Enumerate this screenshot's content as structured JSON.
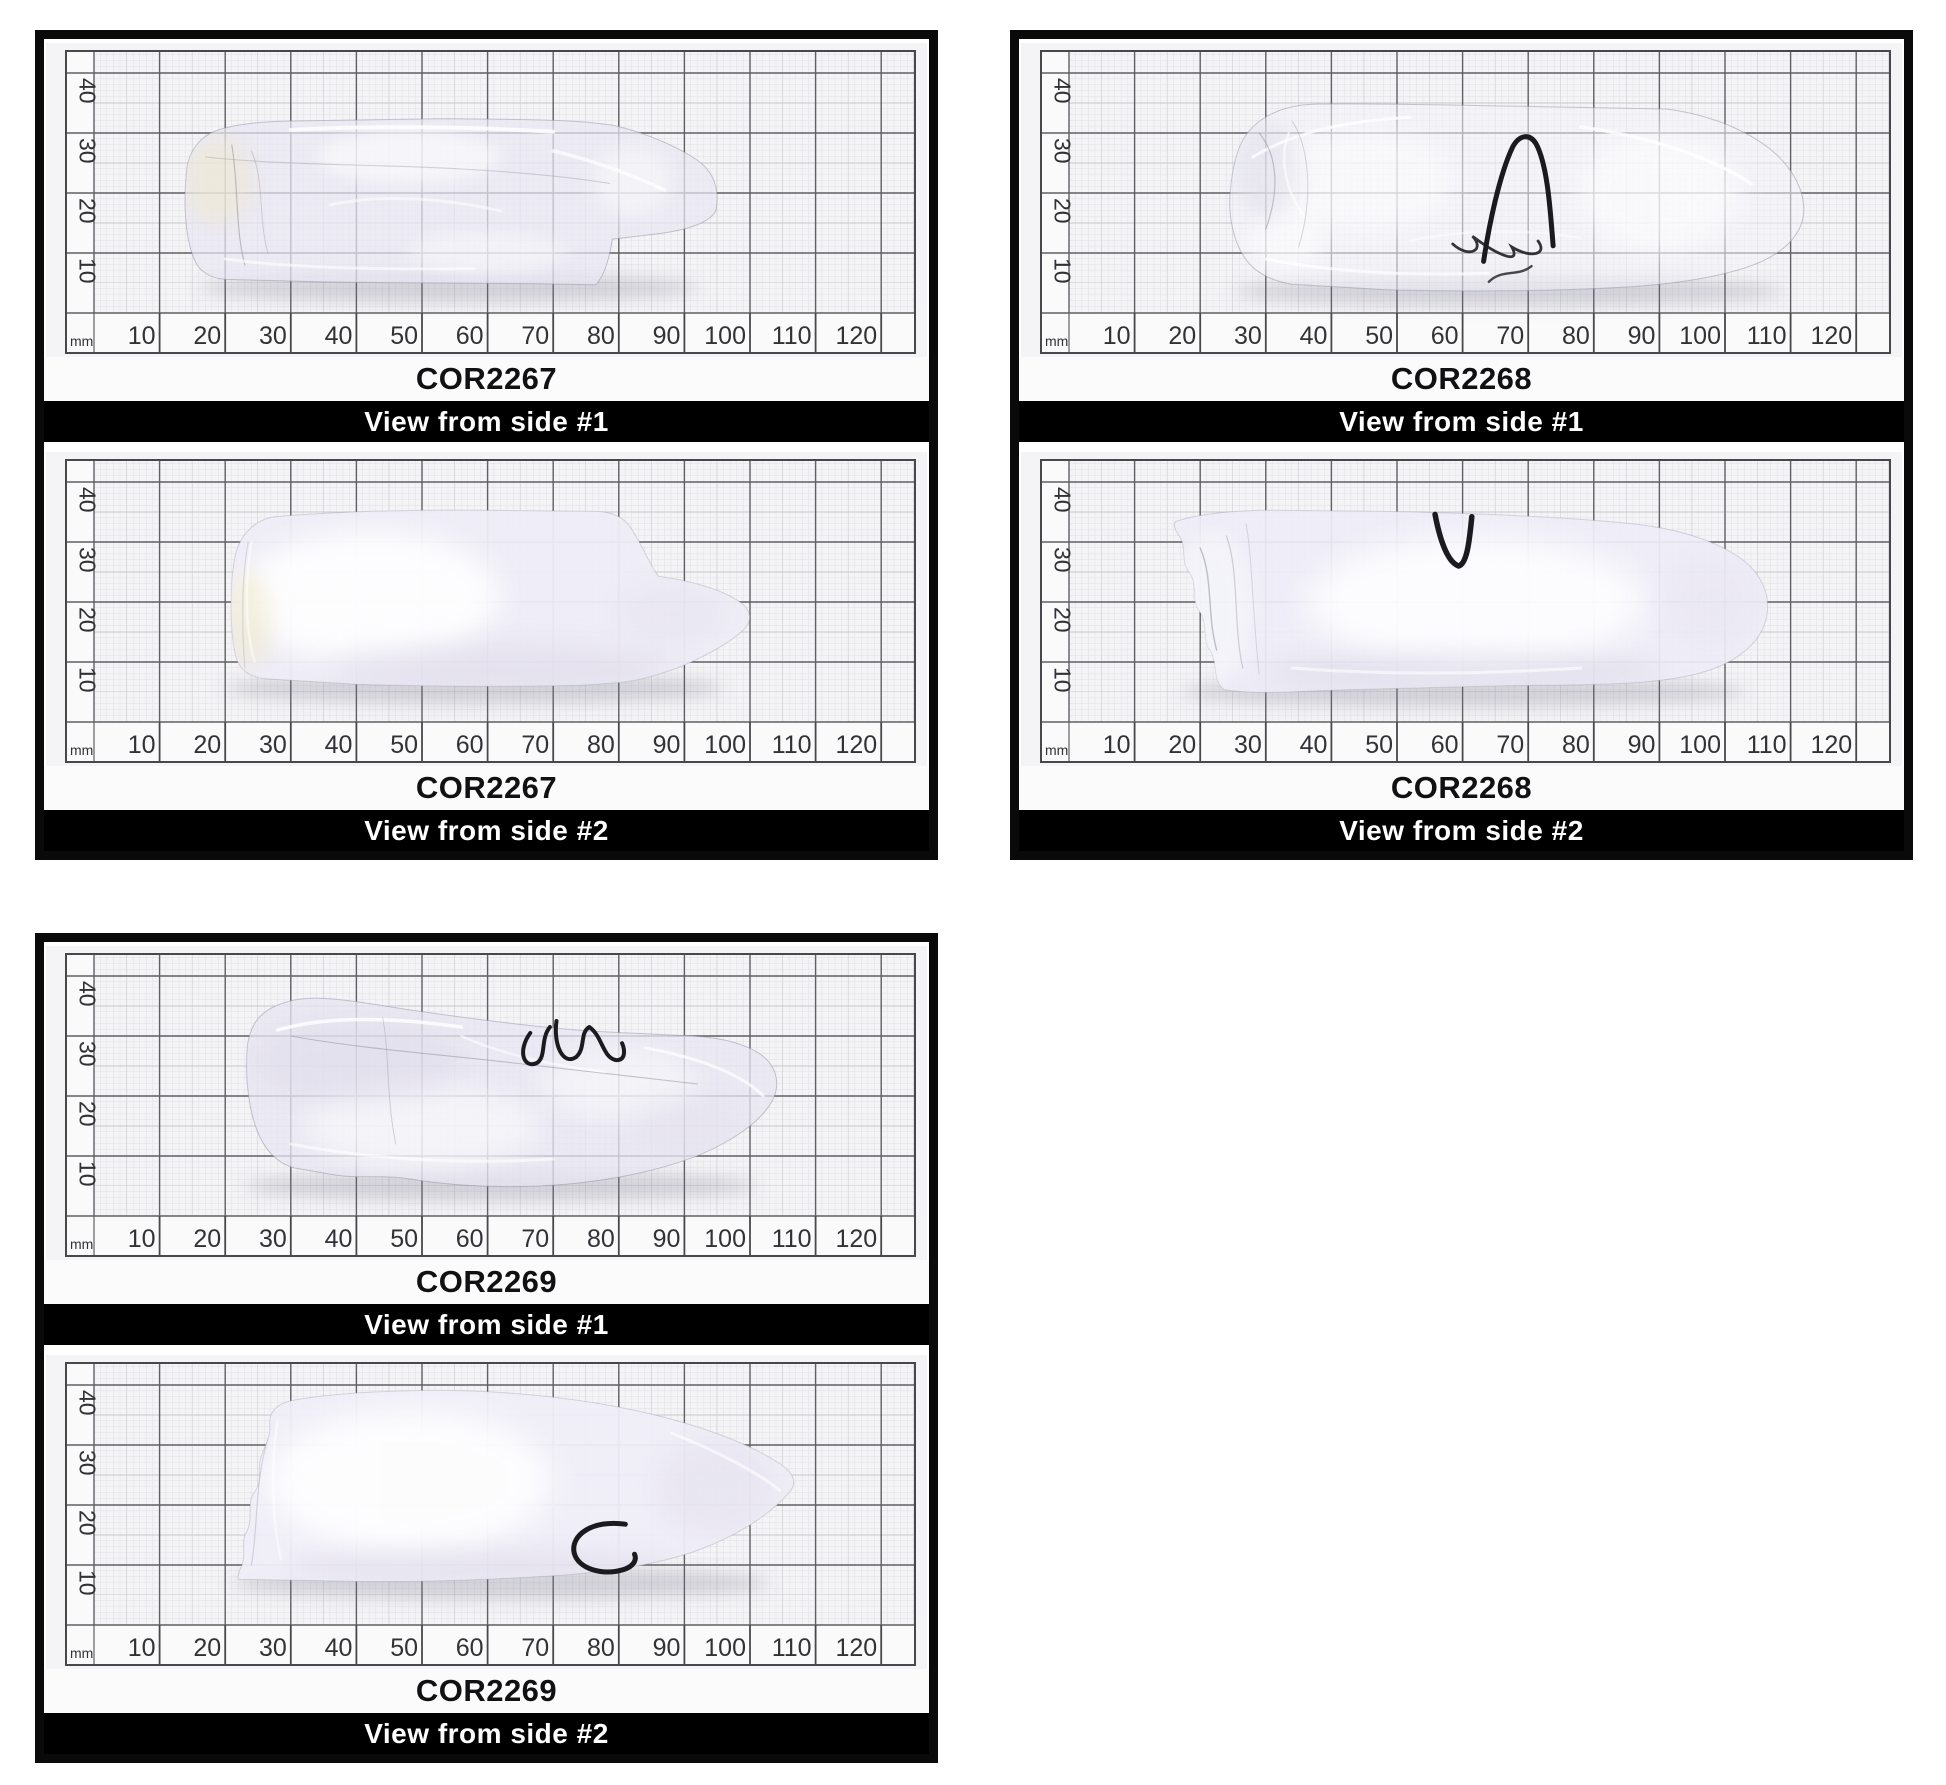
{
  "ruler": {
    "unit_label": "mm",
    "x_ticks": [
      10,
      20,
      30,
      40,
      50,
      60,
      70,
      80,
      90,
      100,
      110,
      120
    ],
    "y_ticks": [
      10,
      20,
      30,
      40
    ]
  },
  "colors": {
    "paper": "#f4f3f5",
    "ruler_strip": "#fafafb",
    "grid_fine": "#dcdde0",
    "grid_mid": "#c6c8cc",
    "grid_major": "#5f6064",
    "frame": "#47484c",
    "tick_text": "#323236",
    "shadow": "rgba(110,110,132,0.25)",
    "marker": "#1b1b1f",
    "border": "#0a0a0a",
    "caption_bg": "#000000",
    "caption_text": "#ffffff"
  },
  "panels": [
    {
      "views": [
        {
          "label": "COR2267",
          "caption": "View from side #1",
          "crystal": {
            "style": "clear",
            "fill": "rgba(233,230,243,0.72)",
            "outline": "rgba(145,145,165,0.5)",
            "path": "M14.2 24.5 C13.6 19 13.8 13 15.2 9.2 C15.8 7.2 17.5 5.8 20 5.6 L34 5.2 C48 4.9 62 5.1 76.5 4.7 C78 6.5 78.6 9.5 79 12.3 L86 13.2 C90 13.8 93.6 14.8 94.8 17 C95.4 20.5 94.6 23.5 91.8 25.6 C88.5 28 84 30 79.5 31.2 C73 32.4 64 32.2 54 32.4 L30 32 C25 31.9 20.5 31.4 17.8 30 C15.8 28.8 14.6 26.8 14.2 24.5 Z",
            "shadow": {
              "cx": 54,
              "cy": 4.2,
              "rx": 38,
              "ry": 2.4
            },
            "blobs": [
              {
                "cx": 19,
                "cy": 22,
                "rx": 5,
                "ry": 7,
                "fill": "#efe8c8",
                "o": 0.5,
                "blur": 1.5
              },
              {
                "cx": 48,
                "cy": 26,
                "rx": 14,
                "ry": 4.5,
                "fill": "#ffffff",
                "o": 0.55,
                "blur": 1.2
              },
              {
                "cx": 60,
                "cy": 10,
                "rx": 12,
                "ry": 3.5,
                "fill": "#ffffff",
                "o": 0.4,
                "blur": 1.2
              },
              {
                "cx": 82,
                "cy": 22,
                "rx": 6,
                "ry": 6,
                "fill": "#ffffff",
                "o": 0.45,
                "blur": 1.5
              }
            ],
            "strokes": [
              {
                "d": "M21 28 C22 22 21.5 14 23 8",
                "w": 1.2,
                "o": 0.5,
                "color": "#8b8b96"
              },
              {
                "d": "M24 27 C26 22 25 16 26.5 10",
                "w": 1,
                "o": 0.4,
                "color": "#9a9aa4"
              },
              {
                "d": "M17 26 C30 24.5 44 24.8 56 24 C66 23.4 73 22.6 78.6 21.6",
                "w": 1.1,
                "o": 0.45,
                "color": "#a2a2ac"
              },
              {
                "d": "M30 30.5 C42 31.3 58 31 70 30.2",
                "w": 4,
                "o": 0.8
              },
              {
                "d": "M36 18 C44 20 54 19 62 17",
                "w": 3,
                "o": 0.55
              },
              {
                "d": "M70 27 C76 25.5 82 23 87 20.5",
                "w": 3.5,
                "o": 0.7
              },
              {
                "d": "M20 9 C30 7.5 44 7.2 58 7.4",
                "w": 3,
                "o": 0.6
              }
            ]
          }
        },
        {
          "label": "COR2267",
          "caption": "View from side #2",
          "crystal": {
            "style": "frosted",
            "fill": "rgba(238,236,246,0.95)",
            "outline": "rgba(150,150,170,0.35)",
            "path": "M21.8 28.8 C20.7 25 20.6 15.5 21.6 11 C22.1 8.9 23.4 7.6 26 7.2 L40 6.3 C52 5.9 64 5.9 74 6.1 L80.5 6.6 C83.3 7 86.6 8 89.8 9.4 C93.6 11.2 97.6 13.6 99.4 15.8 C100.3 17.2 100.1 18.6 98.6 19.9 C95.8 22.1 90.8 23.6 86 24.3 C84.4 26.9 83.2 30.3 81.6 32.7 C80.6 34.2 78.9 35 76.6 35.1 L58 35.3 C46 35.4 34 34.9 27.6 34.2 C24.8 33.8 22.8 31.8 21.8 28.8 Z",
            "shadow": {
              "cx": 58,
              "cy": 5.6,
              "rx": 38,
              "ry": 2.6
            },
            "blobs": [
              {
                "cx": 42,
                "cy": 21,
                "rx": 20,
                "ry": 11,
                "fill": "#ffffff",
                "o": 0.85,
                "blur": 2.2
              },
              {
                "cx": 23.5,
                "cy": 17,
                "rx": 3.5,
                "ry": 8,
                "fill": "#efe9c6",
                "o": 0.5,
                "blur": 1.4
              },
              {
                "cx": 62,
                "cy": 9,
                "rx": 26,
                "ry": 4,
                "fill": "#dcd8e8",
                "o": 0.5,
                "blur": 2
              },
              {
                "cx": 88,
                "cy": 18,
                "rx": 8,
                "ry": 5,
                "fill": "#e4e1ee",
                "o": 0.45,
                "blur": 2
              }
            ],
            "strokes": [
              {
                "d": "M24 30 C23 24 23 15 24.5 10",
                "w": 2.5,
                "o": 0.5
              },
              {
                "d": "M23 9 C22.5 16 22.5 24 23.5 30",
                "w": 1.2,
                "o": 0.35,
                "color": "#a8a8b4"
              }
            ]
          }
        }
      ]
    },
    {
      "views": [
        {
          "label": "COR2268",
          "caption": "View from side #1",
          "crystal": {
            "style": "clear",
            "fill": "rgba(243,243,249,0.55)",
            "outline": "rgba(145,145,165,0.5)",
            "path": "M24.6 20.5 C24.2 16.5 25 12 26.8 9.2 C28.2 6.9 30.6 5.4 34 4.8 L48 3.9 C60 3.5 74 3.6 86 4.4 C93.5 5 100.8 6.3 105.6 8.6 C109.6 10.6 111.9 13.6 112 17 C112.1 20.6 110.2 24.4 106.8 27.4 C102.8 30.8 97 33.2 91 34 L66 34.5 C56 34.7 44 35 37.2 34.8 C32.4 34.6 28.8 32.6 26.8 29.4 C25.4 26.9 24.9 23.8 24.6 20.5 Z",
            "shadow": {
              "cx": 67,
              "cy": 3.6,
              "rx": 42,
              "ry": 2.4
            },
            "blobs": [
              {
                "cx": 45,
                "cy": 22,
                "rx": 14,
                "ry": 9,
                "fill": "#ffffff",
                "o": 0.5,
                "blur": 2
              },
              {
                "cx": 90,
                "cy": 20,
                "rx": 13,
                "ry": 10,
                "fill": "#ffffff",
                "o": 0.55,
                "blur": 2
              },
              {
                "cx": 33,
                "cy": 12,
                "rx": 6,
                "ry": 5,
                "fill": "#ffffff",
                "o": 0.5,
                "blur": 1.5
              },
              {
                "cx": 30,
                "cy": 24,
                "rx": 5,
                "ry": 8,
                "fill": "#dfdde9",
                "o": 0.5,
                "blur": 1.6
              }
            ],
            "strokes": [
              {
                "d": "M28 26 C34 30 42 32 52 32.6",
                "w": 3,
                "o": 0.75
              },
              {
                "d": "M30 9 C40 6.8 52 6.2 64 6.6",
                "w": 3,
                "o": 0.7
              },
              {
                "d": "M78 31 C88 29.5 98 26 104 21.5",
                "w": 3.5,
                "o": 0.8
              },
              {
                "d": "M36 16 C33 20 32 26 33.5 30",
                "w": 2.5,
                "o": 0.6
              },
              {
                "d": "M52 12 C60 14 70 14 78 12.5",
                "w": 2.5,
                "o": 0.5
              },
              {
                "d": "M29 30 C32 26 32 20 30 14",
                "w": 1.2,
                "o": 0.5,
                "color": "#90909a"
              },
              {
                "d": "M34 32 C37 27 37 18 35 11",
                "w": 1,
                "o": 0.4,
                "color": "#9a9aa4"
              },
              {
                "d": "M58.5 11.5 C61 9 63.5 10.5 61.5 12.8 C65.5 9.5 69 8 67.5 11 C70.5 9 73 9.8 71.5 12",
                "w": 2.8,
                "o": 0.9,
                "color": "#202024"
              },
              {
                "d": "M64 5.2 C66 7.4 68.5 6 70.5 7.8",
                "w": 2.4,
                "o": 0.85,
                "color": "#2a2a2e"
              }
            ],
            "marker": {
              "d": "M63.2 8.6 C64 14.5 65.6 23 67.6 27.6 C68.6 29.7 70.2 30 71.2 28.2 C73 24.6 73.4 16.5 73.8 11.2",
              "w": 5
            }
          }
        },
        {
          "label": "COR2268",
          "caption": "View from side #2",
          "crystal": {
            "style": "frosted",
            "fill": "rgba(238,236,246,0.93)",
            "outline": "rgba(150,150,170,0.35)",
            "path": "M16.2 33.4 C19.4 34.6 24.4 35.2 30 35.3 L48 35.1 C62 34.8 76 34.2 87 32.9 C93.6 32 99.8 29.8 103.4 26.4 C106.2 23.6 107.2 19.8 106 16.2 C104.8 12.6 101.2 9.6 96 8.1 C88 5.8 76 6.3 64 6 L40 5.3 C34 5 28 4.6 23.6 5.4 C21.8 7 22.8 9.6 21.6 11.8 C20.2 13.4 21.4 16.4 19.8 18.6 C18.6 20.4 19.8 23 18.2 25.2 C17 27 18 29.3 16.8 31 C16.2 31.9 15.9 32.8 16.2 33.4 Z",
            "shadow": {
              "cx": 60,
              "cy": 5,
              "rx": 43,
              "ry": 2.5
            },
            "blobs": [
              {
                "cx": 62,
                "cy": 20,
                "rx": 26,
                "ry": 11,
                "fill": "#ffffff",
                "o": 0.8,
                "blur": 2.5
              },
              {
                "cx": 22,
                "cy": 19,
                "rx": 6,
                "ry": 13,
                "fill": "#f6f7fa",
                "o": 0.7,
                "blur": 1.5
              },
              {
                "cx": 60,
                "cy": 8.5,
                "rx": 30,
                "ry": 3,
                "fill": "#d8d5e4",
                "o": 0.45,
                "blur": 1.8
              },
              {
                "cx": 98,
                "cy": 20,
                "rx": 7,
                "ry": 7,
                "fill": "#e6e3ef",
                "o": 0.4,
                "blur": 2
              }
            ],
            "strokes": [
              {
                "d": "M20 29 C22 24 21 18 22.5 12",
                "w": 1.4,
                "o": 0.6,
                "color": "#9a9aa6"
              },
              {
                "d": "M24 31 C26 25 25 16 26.5 9",
                "w": 1.2,
                "o": 0.5,
                "color": "#a6a6b0"
              },
              {
                "d": "M27 33 C28 27 28 17 29 8",
                "w": 1,
                "o": 0.4,
                "color": "#ababb6"
              },
              {
                "d": "M34 9 C48 7.8 64 8 78 9",
                "w": 3,
                "o": 0.6
              }
            ],
            "marker": {
              "d": "M55.8 34.6 C56.6 30 57.8 26.6 59.4 26 C60.6 26.4 61 29.6 61.4 34.2",
              "w": 5.5
            }
          }
        }
      ]
    },
    {
      "views": [
        {
          "label": "COR2269",
          "caption": "View from side #1",
          "crystal": {
            "style": "clear",
            "fill": "rgba(232,229,242,0.75)",
            "outline": "rgba(145,145,165,0.5)",
            "path": "M23.4 28.5 C23 24 23.4 18.5 24.8 14.4 C26 11 28 8.7 30.6 8 L36.4 6.9 C40 6.2 44.4 6.9 48 6.2 C54 5.1 61 4.7 68 5 C76 5.4 84.6 7 91.4 9.8 C97 12.2 101.6 15.6 103.4 19.2 C104.6 21.8 104.2 24.6 102 26.6 C99 29.2 94 30 89 30.1 L76 30.8 C68 31.4 58 32.8 49 34.2 C44 35 38.6 36.2 34.2 36.3 C30 36.4 26.4 35 24.8 32.6 C24 31.4 23.6 30 23.4 28.5 Z",
            "shadow": {
              "cx": 62,
              "cy": 5,
              "rx": 39,
              "ry": 2.5
            },
            "blobs": [
              {
                "cx": 50,
                "cy": 15,
                "rx": 18,
                "ry": 7,
                "fill": "#ffffff",
                "o": 0.5,
                "blur": 2
              },
              {
                "cx": 80,
                "cy": 22,
                "rx": 12,
                "ry": 6,
                "fill": "#ffffff",
                "o": 0.45,
                "blur": 2
              },
              {
                "cx": 40,
                "cy": 26,
                "rx": 16,
                "ry": 7,
                "fill": "#dedaea",
                "o": 0.5,
                "blur": 2
              },
              {
                "cx": 90,
                "cy": 15,
                "rx": 8,
                "ry": 5,
                "fill": "#e3e0ed",
                "o": 0.45,
                "blur": 2
              }
            ],
            "strokes": [
              {
                "d": "M28 31 C36 33.5 46 33 56 31.5",
                "w": 3.5,
                "o": 0.8
              },
              {
                "d": "M30 12 C42 9.5 56 8.5 70 9.5",
                "w": 3,
                "o": 0.6
              },
              {
                "d": "M84 28 C92 26.5 99 23.5 102 20",
                "w": 3,
                "o": 0.7
              },
              {
                "d": "M30 30 C40 28 52 27 64 25.5 C74 24.2 84 23 92 22",
                "w": 1.1,
                "o": 0.5,
                "color": "#8e8e9a"
              },
              {
                "d": "M44 33 C45 28 44.5 20 46 12",
                "w": 1,
                "o": 0.4,
                "color": "#9a9aa6"
              },
              {
                "d": "M56 30 C62 27 70 25 78 24",
                "w": 2.5,
                "o": 0.55
              }
            ],
            "marker": {
              "d": "M66.5 30.5 C64.5 27.5 65.5 24.5 67.5 25.5 C69 26.5 68 29.5 69.5 31.5 M70.5 32.5 C70 28.5 71.5 25 73.5 26.5 C75 28 74 30.5 75.5 31.5 C77.5 30 77.5 26.5 79.5 26 C81 25.8 81 27.5 80.5 28.8",
              "w": 4
            }
          }
        },
        {
          "label": "COR2269",
          "caption": "View from side #2",
          "crystal": {
            "style": "frosted",
            "fill": "rgba(239,237,247,0.95)",
            "outline": "rgba(150,150,170,0.35)",
            "path": "M22 7.6 L34 7.4 C46 7 58 7.4 70 8.2 C78 8.8 86 10 92.4 12.6 C98.2 15 103.4 18.6 106.2 22.4 C107.2 23.9 106.6 25.4 104.4 27 C99.6 30.4 92 33.4 84 35.4 C74 37.9 62 39.2 51 39.1 C44 39 36.4 38.6 30.6 37.5 C28 37 26.6 35.6 26.8 33.4 C27 31.5 26 29.8 25.4 27.8 C24.9 26.1 25.8 24 24.4 22 C23.2 20.3 24.4 17.6 23.2 15.4 C22.3 13.7 23.3 11.4 22.4 9.6 C22.1 8.9 21.9 8.2 22 7.6 Z",
            "shadow": {
              "cx": 62,
              "cy": 7,
              "rx": 41,
              "ry": 2.7
            },
            "blobs": [
              {
                "cx": 48,
                "cy": 24,
                "rx": 22,
                "ry": 12,
                "fill": "#ffffff",
                "o": 0.85,
                "blur": 2.5
              },
              {
                "cx": 95,
                "cy": 23,
                "rx": 9,
                "ry": 8,
                "fill": "#dfdbe9",
                "o": 0.4,
                "blur": 2
              },
              {
                "cx": 60,
                "cy": 10,
                "rx": 30,
                "ry": 2.5,
                "fill": "#d9d5e5",
                "o": 0.4,
                "blur": 1.6
              }
            ],
            "strokes": [
              {
                "d": "M28 34 C27 28 27 18 28.5 11",
                "w": 2.5,
                "o": 0.5
              },
              {
                "d": "M88 32 C95 29 101 25.5 104.5 22.5",
                "w": 3,
                "o": 0.6
              },
              {
                "d": "M24 10 C25 16 24.5 24 26.5 31",
                "w": 1.2,
                "o": 0.4,
                "color": "#a4a4b0"
              }
            ],
            "marker": {
              "d": "M81 16.8 C76 17.6 72.6 15 73.2 12 C73.8 9.4 77.4 8.2 80.6 9.2 C82.2 9.7 82.8 10.8 82.4 11.8",
              "w": 5
            }
          }
        }
      ]
    }
  ]
}
